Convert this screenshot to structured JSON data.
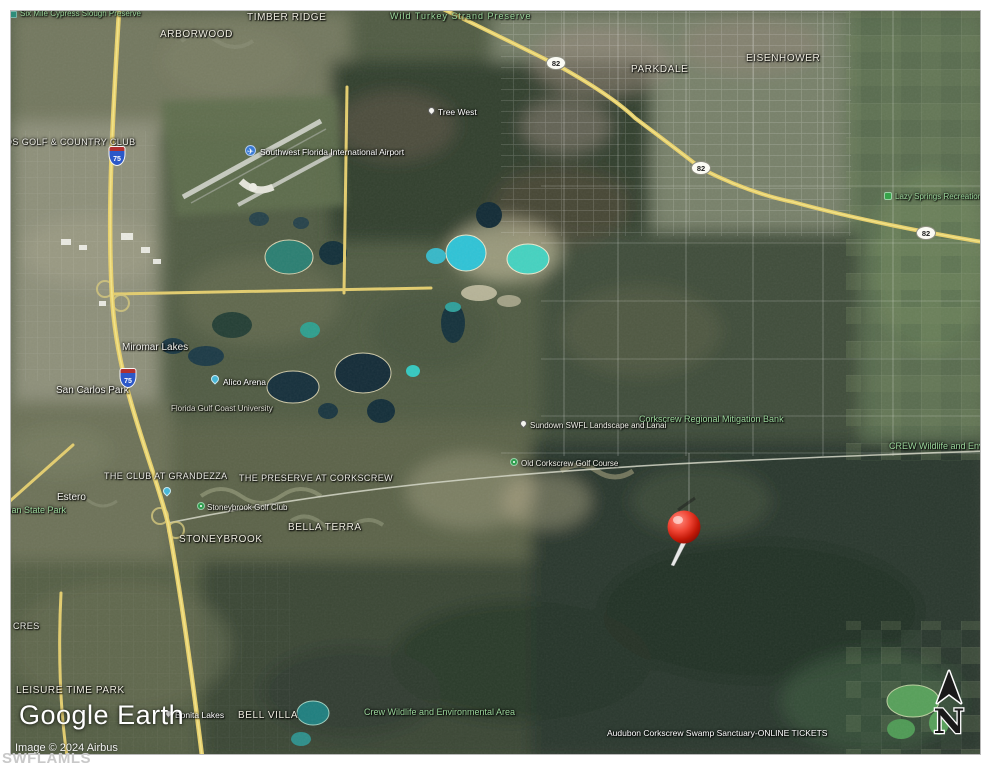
{
  "branding": {
    "logo": "Google Earth",
    "attribution": "Image © 2024 Airbus",
    "watermark": "SWFLAMLS"
  },
  "map": {
    "compass_letter": "N",
    "pin": {
      "x": 683,
      "y": 526,
      "color": "#e0271a"
    },
    "labels": [
      {
        "id": "six-mile-cypress-slough-preserve",
        "text": "Six Mile Cypress Slough Preserve",
        "x": 19,
        "y": 9,
        "style": "green-sm",
        "icon": "preserve-square",
        "ix": 9,
        "iy": 10,
        "interact": "false"
      },
      {
        "id": "timber-ridge",
        "text": "TIMBER RIDGE",
        "x": 246,
        "y": 11,
        "style": "comm-lg",
        "interact": "false"
      },
      {
        "id": "arborwood",
        "text": "ARBORWOOD",
        "x": 159,
        "y": 28,
        "style": "comm-lg",
        "interact": "false"
      },
      {
        "id": "wild-turkey-strand-preserve",
        "text": "Wild Turkey Strand Preserve",
        "x": 389,
        "y": 11,
        "style": "green-wide",
        "interact": "false"
      },
      {
        "id": "parkdale",
        "text": "PARKDALE",
        "x": 630,
        "y": 63,
        "style": "comm-lg",
        "interact": "false"
      },
      {
        "id": "eisenhower",
        "text": "EISENHOWER",
        "x": 745,
        "y": 52,
        "style": "comm-lg",
        "interact": "false"
      },
      {
        "id": "tree-west",
        "text": "Tree West",
        "x": 437,
        "y": 107,
        "style": "poi",
        "icon": "white-pin",
        "ix": 427,
        "iy": 106,
        "interact": "true"
      },
      {
        "id": "swfl-intl-airport",
        "text": "Southwest Florida International Airport",
        "x": 259,
        "y": 147,
        "style": "poi",
        "icon": "airport",
        "ix": 244,
        "iy": 144,
        "interact": "true"
      },
      {
        "id": "golf-country-club",
        "text": "OS GOLF & COUNTRY CLUB",
        "x": 4,
        "y": 137,
        "style": "comm",
        "interact": "false"
      },
      {
        "id": "lazy-springs-recreation-park",
        "text": "Lazy Springs Recreation Park",
        "x": 894,
        "y": 192,
        "style": "green-sm",
        "icon": "rec-park",
        "ix": 883,
        "iy": 191,
        "interact": "true"
      },
      {
        "id": "miromar-lakes",
        "text": "Miromar Lakes",
        "x": 121,
        "y": 341,
        "style": "place",
        "interact": "false"
      },
      {
        "id": "san-carlos-park",
        "text": "San Carlos Park",
        "x": 55,
        "y": 384,
        "style": "place",
        "interact": "false"
      },
      {
        "id": "alico-arena",
        "text": "Alico Arena",
        "x": 222,
        "y": 377,
        "style": "poi",
        "icon": "blue-pin",
        "ix": 210,
        "iy": 374,
        "interact": "true"
      },
      {
        "id": "florida-gulf-coast-university",
        "text": "Florida Gulf Coast University",
        "x": 170,
        "y": 404,
        "style": "poi-dim",
        "interact": "false"
      },
      {
        "id": "corkscrew-regional-mitigation-bank",
        "text": "Corkscrew Regional Mitigation Bank",
        "x": 638,
        "y": 414,
        "style": "green",
        "interact": "false"
      },
      {
        "id": "sundown-swfl-landscape-lanai",
        "text": "Sundown SWFL Landscape and Lanai",
        "x": 529,
        "y": 421,
        "style": "poi-sm",
        "icon": "white-pin",
        "ix": 519,
        "iy": 419,
        "interact": "true"
      },
      {
        "id": "crew-wildlife-right",
        "text": "CREW Wildlife and Environmental Area",
        "x": 888,
        "y": 441,
        "style": "green",
        "interact": "false"
      },
      {
        "id": "old-corkscrew-golf-course",
        "text": "Old Corkscrew Golf Course",
        "x": 520,
        "y": 459,
        "style": "poi-sm",
        "icon": "golf",
        "ix": 509,
        "iy": 457,
        "interact": "true"
      },
      {
        "id": "the-club-at-grandezza",
        "text": "THE CLUB AT GRANDEZZA",
        "x": 103,
        "y": 471,
        "style": "comm",
        "interact": "false"
      },
      {
        "id": "the-preserve-at-corkscrew",
        "text": "THE PRESERVE AT CORKSCREW",
        "x": 238,
        "y": 473,
        "style": "comm",
        "interact": "false"
      },
      {
        "id": "estero",
        "text": "Estero",
        "x": 56,
        "y": 491,
        "style": "place",
        "interact": "false"
      },
      {
        "id": "koreshan-state-park",
        "text": "Koreshan State Park",
        "x": -18,
        "y": 505,
        "style": "green",
        "interact": "false"
      },
      {
        "id": "estero-blue-poi",
        "text": "",
        "x": 162,
        "y": 486,
        "style": "icon-only",
        "icon": "blue-pin",
        "ix": 162,
        "iy": 486,
        "interact": "true"
      },
      {
        "id": "stoneybrook-golf-club",
        "text": "Stoneybrook Golf Club",
        "x": 206,
        "y": 503,
        "style": "poi-sm",
        "icon": "golf",
        "ix": 196,
        "iy": 501,
        "interact": "true"
      },
      {
        "id": "bella-terra",
        "text": "BELLA TERRA",
        "x": 287,
        "y": 521,
        "style": "comm-lg",
        "interact": "false"
      },
      {
        "id": "stoneybrook",
        "text": "STONEYBROOK",
        "x": 178,
        "y": 533,
        "style": "comm-lg",
        "interact": "false"
      },
      {
        "id": "acres",
        "text": "CRES",
        "x": 12,
        "y": 621,
        "style": "comm",
        "interact": "false"
      },
      {
        "id": "leisure-time-park",
        "text": "LEISURE TIME PARK",
        "x": 15,
        "y": 684,
        "style": "comm-lg",
        "interact": "false"
      },
      {
        "id": "bonita-lakes",
        "text": "Bonita Lakes",
        "x": 174,
        "y": 710,
        "style": "poi",
        "icon": "white-pin",
        "ix": 164,
        "iy": 709,
        "interact": "true"
      },
      {
        "id": "bell-villa",
        "text": "BELL VILLA",
        "x": 237,
        "y": 709,
        "style": "comm-lg",
        "interact": "false"
      },
      {
        "id": "crew-wildlife-bottom",
        "text": "Crew Wildlife and Environmental Area",
        "x": 363,
        "y": 707,
        "style": "green",
        "interact": "false"
      },
      {
        "id": "audubon-corkscrew-swamp-sanctuary",
        "text": "Audubon Corkscrew Swamp Sanctuary-ONLINE TICKETS",
        "x": 606,
        "y": 728,
        "style": "poi",
        "interact": "false"
      }
    ],
    "shields": [
      {
        "id": "route-82-shield-a",
        "text": "82",
        "type": "oval",
        "x": 555,
        "y": 62
      },
      {
        "id": "route-82-shield-b",
        "text": "82",
        "type": "oval",
        "x": 700,
        "y": 167
      },
      {
        "id": "route-82-shield-c",
        "text": "82",
        "type": "oval",
        "x": 925,
        "y": 232
      },
      {
        "id": "i-75-shield-a",
        "text": "75",
        "type": "interstate",
        "x": 116,
        "y": 155
      },
      {
        "id": "i-75-shield-b",
        "text": "75",
        "type": "interstate",
        "x": 127,
        "y": 377
      }
    ]
  },
  "colors": {
    "highway_yellow": "#e8d06a",
    "pin_red": "#e0271a",
    "label_green": "#9ad49a",
    "page_background": "#ffffff"
  }
}
